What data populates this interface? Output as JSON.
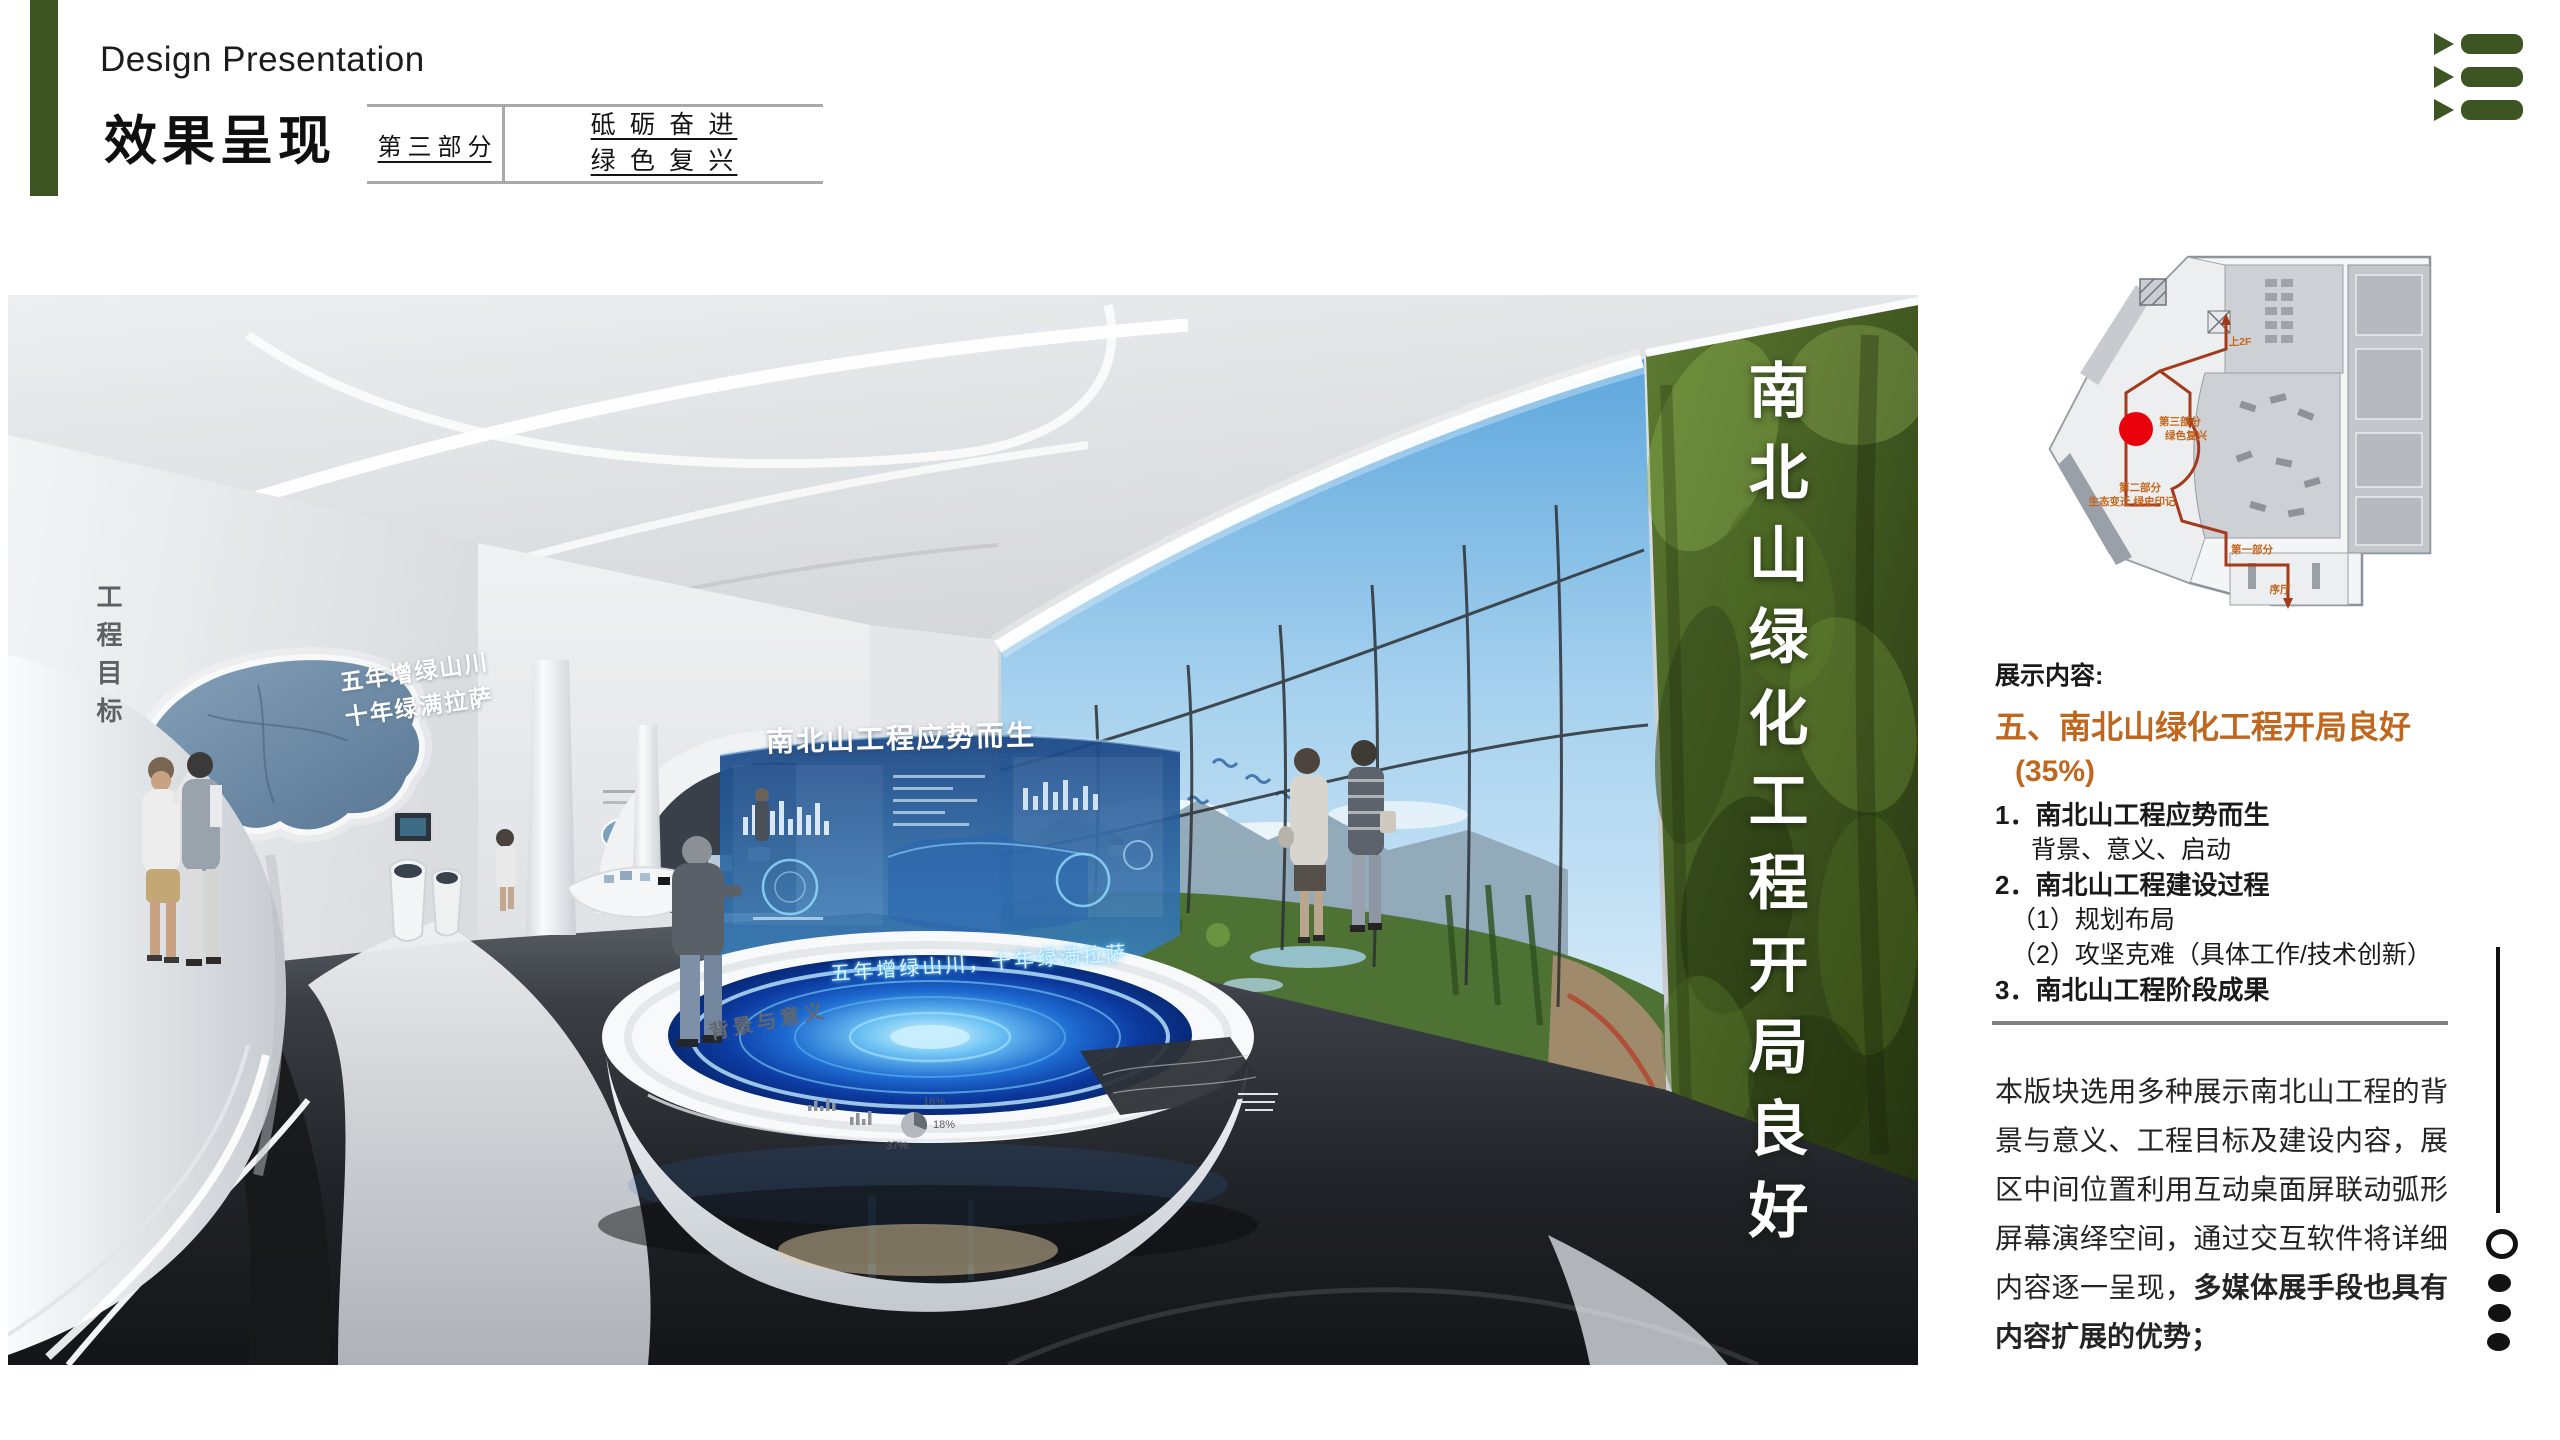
{
  "header": {
    "title_en": "Design Presentation",
    "title_cn": "效果呈现",
    "part_label": "第 三 部 分",
    "slogan_line1": "砥 砺 奋 进",
    "slogan_line2": "绿 色 复 兴",
    "accent_color": "#3d5523",
    "menu_icon": "triangle-list-menu"
  },
  "render": {
    "wall_caption_vertical": "工程目标",
    "map_slogan_line1": "五年增绿山川",
    "map_slogan_line2": "十年绿满拉萨",
    "screen_title": "南北山工程应势而生",
    "green_wall_title": "南北山绿化工程开局良好",
    "table_rim_label": "背景与意义",
    "table_glow_text": "五年增绿山川，十年绿满拉萨",
    "table_chart_labels": [
      "37%",
      "18%",
      "16%"
    ]
  },
  "plan": {
    "marker_color": "#e8000a",
    "route_color": "#a33a1c",
    "labels": [
      {
        "text": "上2F"
      },
      {
        "text": "第三部分"
      },
      {
        "text": "绿色复兴"
      },
      {
        "text": "第二部分"
      },
      {
        "text": "生态变迁 绿史印记"
      },
      {
        "text": "第一部分"
      },
      {
        "text": "序厅"
      }
    ]
  },
  "content": {
    "section_label": "展示内容:",
    "heading": "五、南北山绿化工程开局良好",
    "heading_color": "#bf671e",
    "weight": "(35%)",
    "items": [
      {
        "label": "1．南北山工程应势而生"
      },
      {
        "label": "背景、意义、启动"
      },
      {
        "label": "2．南北山工程建设过程"
      },
      {
        "label": "（1）规划布局"
      },
      {
        "label": "（2）攻坚克难（具体工作/技术创新）"
      },
      {
        "label": "3．南北山工程阶段成果"
      }
    ],
    "paragraph_normal": "本版块选用多种展示南北山工程的背景与意义、工程目标及建设内容，展区中间位置利用互动桌面屏联动弧形屏幕演绎空间，通过交互软件将详细内容逐一呈现，",
    "paragraph_bold": "多媒体展手段也具有内容扩展的优势；"
  },
  "pager": {
    "dot_count": 3
  }
}
